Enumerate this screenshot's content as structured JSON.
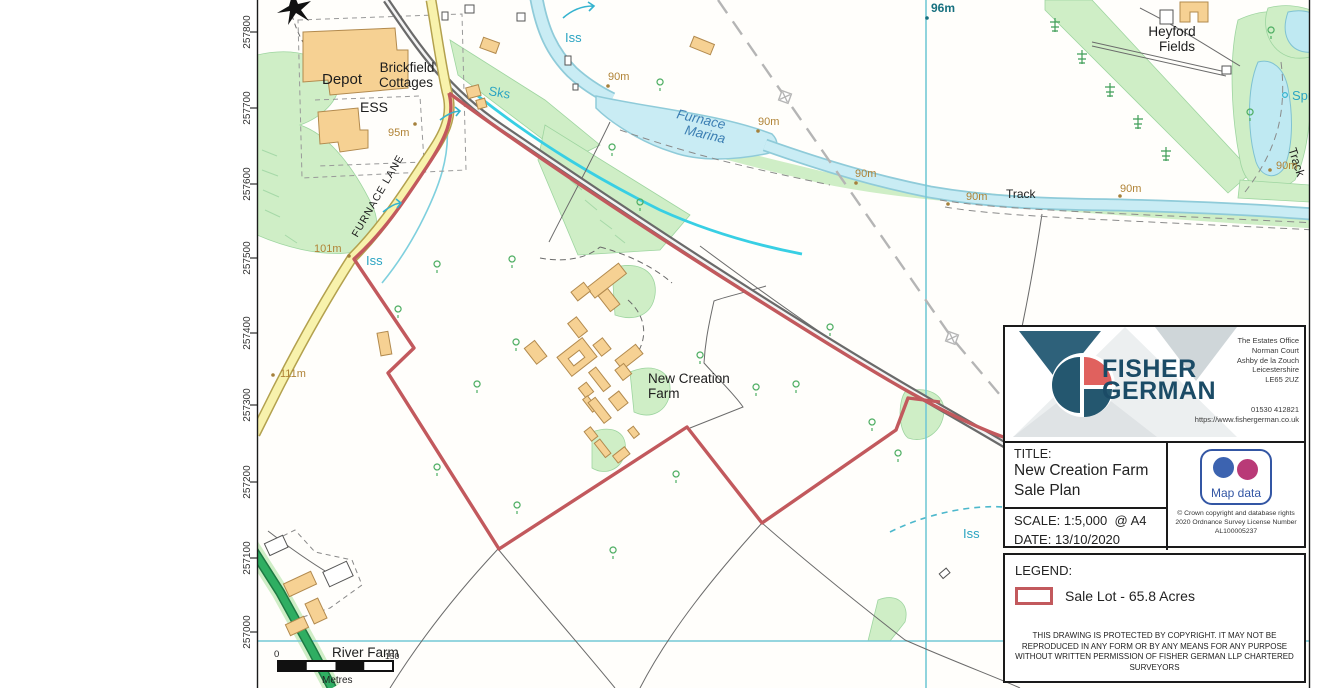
{
  "map": {
    "labels": {
      "depot": "Depot",
      "brickfield_line1": "Brickfield",
      "brickfield_line2": "Cottages",
      "ess": "ESS",
      "furnace_lane": "FURNACE LANE",
      "marina_line1": "Furnace",
      "marina_line2": "Marina",
      "heyford_line1": "Heyford",
      "heyford_line2": "Fields",
      "farm_line1": "New Creation",
      "farm_line2": "Farm",
      "river_farm": "River Farm",
      "track_mid": "Track",
      "track_right": "Track"
    },
    "water_labels": {
      "iss_top": "Iss",
      "sks": "Sks",
      "iss_lane": "Iss",
      "iss_right": "Iss",
      "spr": "Spr"
    },
    "spot_heights": {
      "h95": "95m",
      "h101": "101m",
      "h111": "111m",
      "h96": "96m",
      "h90_a": "90m",
      "h90_b": "90m",
      "h90_c": "90m",
      "h90_d": "90m",
      "h90_e": "90m",
      "h90_f": "90m"
    },
    "northings": [
      "257800",
      "257700",
      "257600",
      "257500",
      "257400",
      "257300",
      "257200",
      "257100",
      "257000"
    ],
    "scale_bar": {
      "start": "0",
      "end": "150",
      "units": "Metres"
    }
  },
  "title_block": {
    "brand": {
      "word1": "FISHER",
      "word2": "GERMAN",
      "address": [
        "The Estates Office",
        "Norman Court",
        "Ashby de la Zouch",
        "Leicestershire",
        "LE65 2UZ"
      ],
      "phone": "01530 412821",
      "website": "https://www.fishergerman.co.uk"
    },
    "title_label": "TITLE:",
    "title_line1": "New Creation Farm",
    "title_line2": "Sale Plan",
    "scale_label": "SCALE:",
    "scale_value": "1:5,000",
    "scale_sheet": "@ A4",
    "date_label": "DATE:",
    "date_value": "13/10/2020",
    "os": {
      "caption": "Map data",
      "copyright": "© Crown copyright and database rights 2020 Ordnance Survey License Number AL100005237"
    }
  },
  "legend": {
    "heading": "LEGEND:",
    "sale_lot_label": "Sale Lot - 65.8 Acres",
    "copyright": "THIS DRAWING IS PROTECTED BY COPYRIGHT. IT MAY NOT BE REPRODUCED IN ANY FORM OR BY ANY MEANS FOR ANY PURPOSE WITHOUT WRITTEN PERMISSION OF FISHER GERMAN LLP CHARTERED SURVEYORS"
  },
  "colors": {
    "sale_boundary": "#c2595d",
    "water_fill": "#c9ecf4",
    "grid_line": "#74c9d6",
    "road_yellow": "#f8f2ac",
    "woodland": "#cfeec6",
    "building": "#f6d193",
    "brand_navy": "#1b4b66",
    "brand_coral": "#e0615e",
    "os_blue": "#3356a4",
    "os_magenta": "#b93a77"
  }
}
